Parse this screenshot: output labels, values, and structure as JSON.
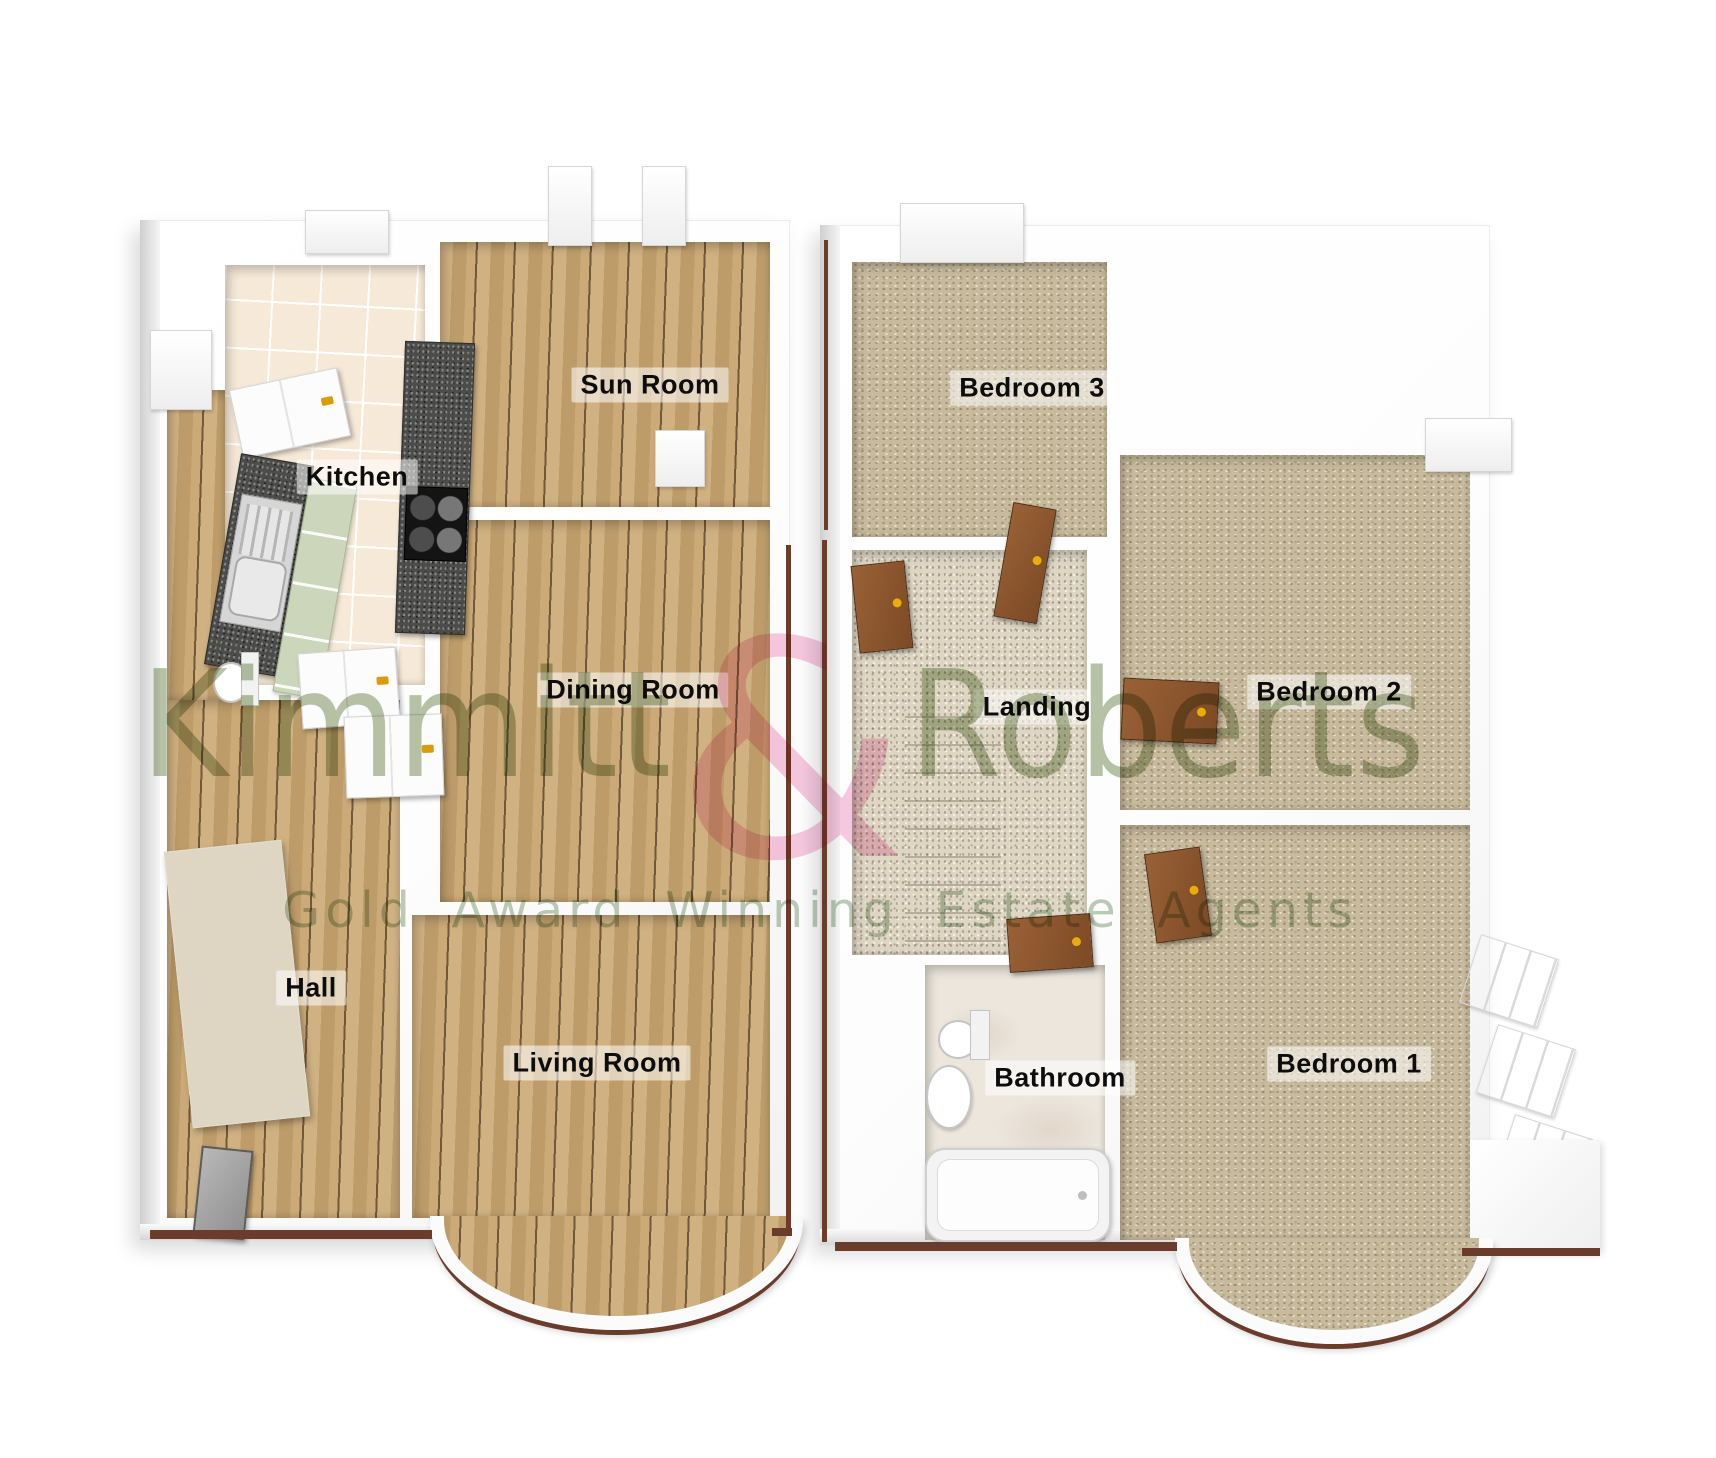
{
  "watermark": {
    "name_left": "Kimmitt",
    "ampersand": "&",
    "name_right": "Roberts",
    "tagline": "Gold Award Winning Estate Agents",
    "pink": "#f7c6df",
    "green": "#7c925c"
  },
  "ground_floor": {
    "rooms": {
      "kitchen": "Kitchen",
      "sun_room": "Sun Room",
      "dining_room": "Dining Room",
      "hall": "Hall",
      "living_room": "Living Room"
    }
  },
  "first_floor": {
    "rooms": {
      "bedroom3": "Bedroom 3",
      "landing": "Landing",
      "bedroom2": "Bedroom 2",
      "bathroom": "Bathroom",
      "bedroom1": "Bedroom 1"
    }
  },
  "colors": {
    "wood": "#c9a671",
    "tile": "#f6e9d8",
    "carpet": "#c8ba9d",
    "stone": "#ded6c3",
    "marble": "#ece6dd",
    "counter_granite": "#4c4c4a",
    "door_brown": "#8a5531",
    "trim_brown": "#6b3c2b",
    "wall_white": "#ffffff"
  }
}
